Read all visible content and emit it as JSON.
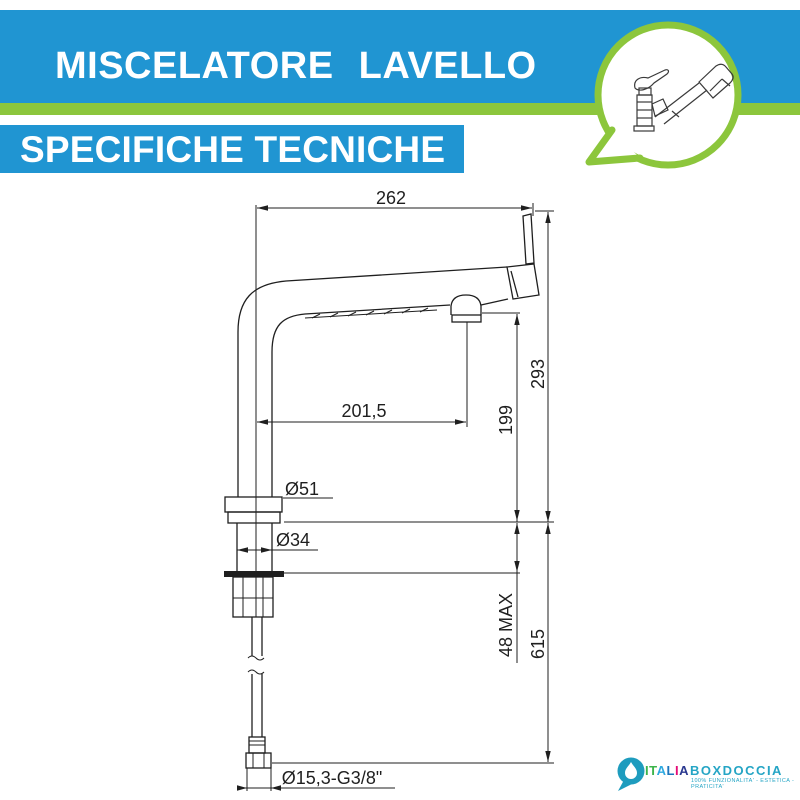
{
  "header": {
    "title1": "MISCELATORE LAVELLO",
    "title2": "SPECIFICHE TECNICHE"
  },
  "colors": {
    "banner_blue": "#2095d2",
    "accent_green": "#8cc63c",
    "line": "#1f1f1f",
    "logo_teal": "#25a5c5"
  },
  "drawing": {
    "dim_total_width": "262",
    "dim_spout_reach": "201,5",
    "dim_total_height": "293",
    "dim_spout_height": "199",
    "dim_deck_max": "48 MAX",
    "dim_below_deck": "615",
    "dia_flange": "Ø51",
    "dia_body": "Ø34",
    "dim_hose_thread": "Ø15,3-G3/8\""
  },
  "logo": {
    "italia_letters": [
      {
        "ch": "I",
        "color": "#3cb44a"
      },
      {
        "ch": "T",
        "color": "#3cb44a"
      },
      {
        "ch": "A",
        "color": "#2fa9e0"
      },
      {
        "ch": "L",
        "color": "#1b75bc"
      },
      {
        "ch": "I",
        "color": "#e40c78"
      },
      {
        "ch": "A",
        "color": "#2b3990"
      }
    ],
    "boxdoccia": "BOXDOCCIA",
    "tagline": "100% FUNZIONALITA' - ESTETICA - PRATICITA'"
  }
}
